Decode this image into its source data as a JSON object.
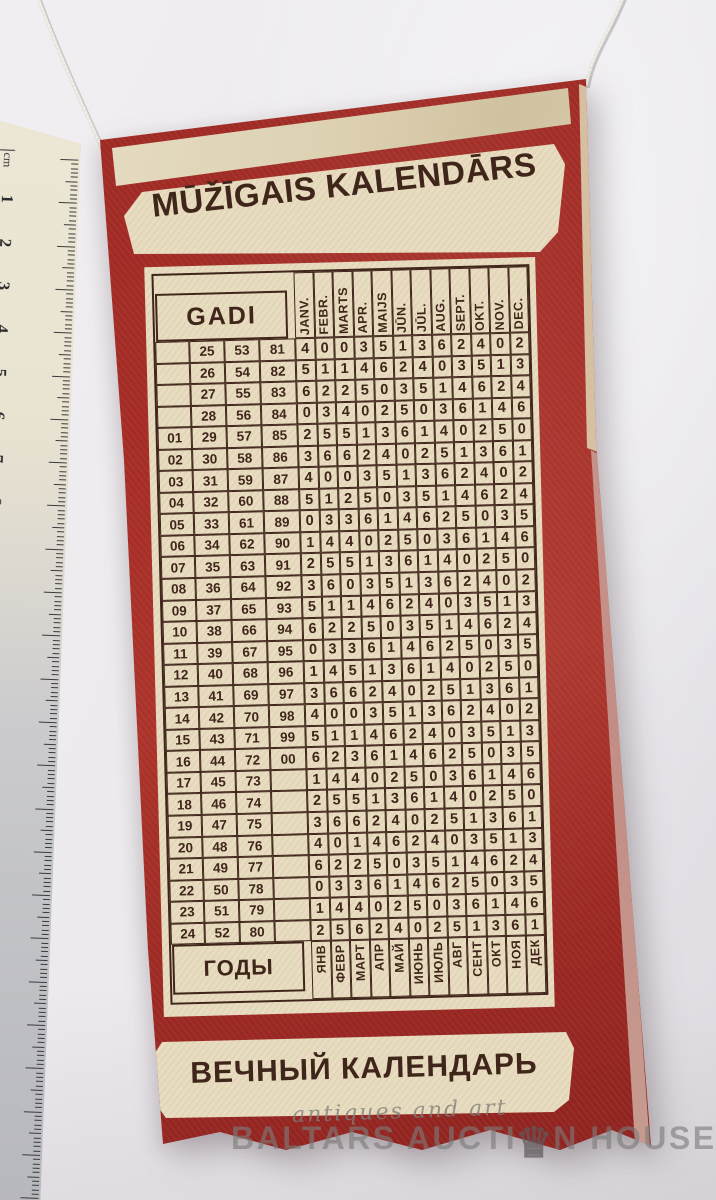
{
  "banner": {
    "title_latvian": "MŪŽĪGAIS KALENDĀRS",
    "title_russian": "ВЕЧНЫЙ КАЛЕНДАРЬ"
  },
  "calendar": {
    "years_label_latvian": "GADI",
    "years_label_russian": "ГОДЫ",
    "months_latvian": [
      "JANV.",
      "FEBR.",
      "MARTS",
      "APR.",
      "MAIJS",
      "JŪN.",
      "JŪL.",
      "AUG.",
      "SEPT.",
      "OKT.",
      "NOV.",
      "DEC."
    ],
    "months_russian": [
      "ЯНВ",
      "ФЕВР",
      "МАРТ",
      "АПР",
      "МАЙ",
      "ИЮНЬ",
      "ИЮЛЬ",
      "АВГ",
      "СЕНТ",
      "ОКТ",
      "НОЯ",
      "ДЕК"
    ],
    "rows": [
      {
        "years": [
          "",
          "25",
          "53",
          "81"
        ],
        "codes": [
          4,
          0,
          0,
          3,
          5,
          1,
          3,
          6,
          2,
          4,
          0,
          2
        ]
      },
      {
        "years": [
          "",
          "26",
          "54",
          "82"
        ],
        "codes": [
          5,
          1,
          1,
          4,
          6,
          2,
          4,
          0,
          3,
          5,
          1,
          3
        ]
      },
      {
        "years": [
          "",
          "27",
          "55",
          "83"
        ],
        "codes": [
          6,
          2,
          2,
          5,
          0,
          3,
          5,
          1,
          4,
          6,
          2,
          4
        ]
      },
      {
        "years": [
          "",
          "28",
          "56",
          "84"
        ],
        "codes": [
          0,
          3,
          4,
          0,
          2,
          5,
          0,
          3,
          6,
          1,
          4,
          6
        ]
      },
      {
        "years": [
          "01",
          "29",
          "57",
          "85"
        ],
        "codes": [
          2,
          5,
          5,
          1,
          3,
          6,
          1,
          4,
          0,
          2,
          5,
          0
        ]
      },
      {
        "years": [
          "02",
          "30",
          "58",
          "86"
        ],
        "codes": [
          3,
          6,
          6,
          2,
          4,
          0,
          2,
          5,
          1,
          3,
          6,
          1
        ]
      },
      {
        "years": [
          "03",
          "31",
          "59",
          "87"
        ],
        "codes": [
          4,
          0,
          0,
          3,
          5,
          1,
          3,
          6,
          2,
          4,
          0,
          2
        ]
      },
      {
        "years": [
          "04",
          "32",
          "60",
          "88"
        ],
        "codes": [
          5,
          1,
          2,
          5,
          0,
          3,
          5,
          1,
          4,
          6,
          2,
          4
        ]
      },
      {
        "years": [
          "05",
          "33",
          "61",
          "89"
        ],
        "codes": [
          0,
          3,
          3,
          6,
          1,
          4,
          6,
          2,
          5,
          0,
          3,
          5
        ]
      },
      {
        "years": [
          "06",
          "34",
          "62",
          "90"
        ],
        "codes": [
          1,
          4,
          4,
          0,
          2,
          5,
          0,
          3,
          6,
          1,
          4,
          6
        ]
      },
      {
        "years": [
          "07",
          "35",
          "63",
          "91"
        ],
        "codes": [
          2,
          5,
          5,
          1,
          3,
          6,
          1,
          4,
          0,
          2,
          5,
          0
        ]
      },
      {
        "years": [
          "08",
          "36",
          "64",
          "92"
        ],
        "codes": [
          3,
          6,
          0,
          3,
          5,
          1,
          3,
          6,
          2,
          4,
          0,
          2
        ]
      },
      {
        "years": [
          "09",
          "37",
          "65",
          "93"
        ],
        "codes": [
          5,
          1,
          1,
          4,
          6,
          2,
          4,
          0,
          3,
          5,
          1,
          3
        ]
      },
      {
        "years": [
          "10",
          "38",
          "66",
          "94"
        ],
        "codes": [
          6,
          2,
          2,
          5,
          0,
          3,
          5,
          1,
          4,
          6,
          2,
          4
        ]
      },
      {
        "years": [
          "11",
          "39",
          "67",
          "95"
        ],
        "codes": [
          0,
          3,
          3,
          6,
          1,
          4,
          6,
          2,
          5,
          0,
          3,
          5
        ]
      },
      {
        "years": [
          "12",
          "40",
          "68",
          "96"
        ],
        "codes": [
          1,
          4,
          5,
          1,
          3,
          6,
          1,
          4,
          0,
          2,
          5,
          0
        ]
      },
      {
        "years": [
          "13",
          "41",
          "69",
          "97"
        ],
        "codes": [
          3,
          6,
          6,
          2,
          4,
          0,
          2,
          5,
          1,
          3,
          6,
          1
        ]
      },
      {
        "years": [
          "14",
          "42",
          "70",
          "98"
        ],
        "codes": [
          4,
          0,
          0,
          3,
          5,
          1,
          3,
          6,
          2,
          4,
          0,
          2
        ]
      },
      {
        "years": [
          "15",
          "43",
          "71",
          "99"
        ],
        "codes": [
          5,
          1,
          1,
          4,
          6,
          2,
          4,
          0,
          3,
          5,
          1,
          3
        ]
      },
      {
        "years": [
          "16",
          "44",
          "72",
          "00"
        ],
        "codes": [
          6,
          2,
          3,
          6,
          1,
          4,
          6,
          2,
          5,
          0,
          3,
          5
        ]
      },
      {
        "years": [
          "17",
          "45",
          "73",
          ""
        ],
        "codes": [
          1,
          4,
          4,
          0,
          2,
          5,
          0,
          3,
          6,
          1,
          4,
          6
        ]
      },
      {
        "years": [
          "18",
          "46",
          "74",
          ""
        ],
        "codes": [
          2,
          5,
          5,
          1,
          3,
          6,
          1,
          4,
          0,
          2,
          5,
          0
        ]
      },
      {
        "years": [
          "19",
          "47",
          "75",
          ""
        ],
        "codes": [
          3,
          6,
          6,
          2,
          4,
          0,
          2,
          5,
          1,
          3,
          6,
          1
        ]
      },
      {
        "years": [
          "20",
          "48",
          "76",
          ""
        ],
        "codes": [
          4,
          0,
          1,
          4,
          6,
          2,
          4,
          0,
          3,
          5,
          1,
          3
        ]
      },
      {
        "years": [
          "21",
          "49",
          "77",
          ""
        ],
        "codes": [
          6,
          2,
          2,
          5,
          0,
          3,
          5,
          1,
          4,
          6,
          2,
          4
        ]
      },
      {
        "years": [
          "22",
          "50",
          "78",
          ""
        ],
        "codes": [
          0,
          3,
          3,
          6,
          1,
          4,
          6,
          2,
          5,
          0,
          3,
          5
        ]
      },
      {
        "years": [
          "23",
          "51",
          "79",
          ""
        ],
        "codes": [
          1,
          4,
          4,
          0,
          2,
          5,
          0,
          3,
          6,
          1,
          4,
          6
        ]
      },
      {
        "years": [
          "24",
          "52",
          "80",
          ""
        ],
        "codes": [
          2,
          5,
          6,
          2,
          4,
          0,
          2,
          5,
          1,
          3,
          6,
          1
        ]
      }
    ]
  },
  "ruler": {
    "unit_label": "cm",
    "numbers": [
      "1",
      "2",
      "3",
      "4",
      "5",
      "6",
      "7",
      "8",
      "9",
      "10",
      "11",
      "12",
      "13",
      "14",
      "15",
      "16",
      "17",
      "18",
      "19",
      "20",
      "21",
      "22",
      "23"
    ]
  },
  "watermark": {
    "script_line": "antiques and art",
    "brand_left": "BALTARS AUCTI",
    "brand_right": "N HOUSE",
    "crown_glyph": "♛"
  },
  "colors": {
    "pennant_red": "#a12a26",
    "fabric_cream": "#e8ddc1",
    "ink_brown": "#40251a",
    "background_gray": "#eceaee",
    "watermark_gray": "#8f8d8c"
  }
}
